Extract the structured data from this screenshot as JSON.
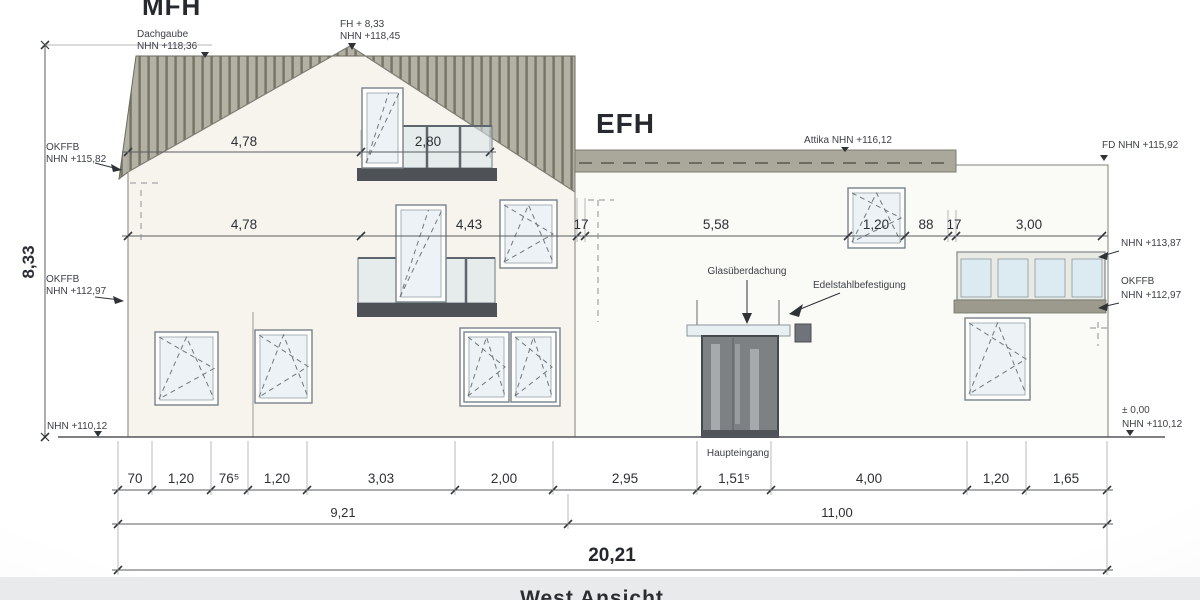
{
  "titles": {
    "mfh": "MFH",
    "efh": "EFH",
    "view": "West Ansicht"
  },
  "levels": {
    "dachgaube_1": "Dachgaube",
    "dachgaube_2": "NHN +118,36",
    "fh_1": "FH + 8,33",
    "fh_2": "NHN +118,45",
    "attika": "Attika NHN +116,12",
    "fd": "FD NHN +115,92",
    "okffb_left_up_1": "OKFFB",
    "okffb_left_up_2": "NHN +115,82",
    "okffb_left_low_1": "OKFFB",
    "okffb_left_low_2": "NHN +112,97",
    "ground_left": "NHN +110,12",
    "right_113": "NHN +113,87",
    "okffb_right_1": "OKFFB",
    "okffb_right_2": "NHN +112,97",
    "zero_right_1": "± 0,00",
    "zero_right_2": "NHN +110,12"
  },
  "entrance": {
    "canopy": "Glasüberdachung",
    "fixing": "Edelstahlbefestigung",
    "entry": "Haupteingang"
  },
  "dims": {
    "height": "8,33",
    "roof": [
      "4,78",
      "2,80"
    ],
    "mid": [
      "4,78",
      "4,43",
      "17",
      "5,58",
      "1,20",
      "88",
      "17",
      "3,00"
    ],
    "bottom": [
      "70",
      "1,20",
      "76⁵",
      "1,20",
      "3,03",
      "2,00",
      "2,95",
      "1,51⁵",
      "4,00",
      "1,20",
      "1,65"
    ],
    "subtotals": [
      "9,21",
      "11,00"
    ],
    "total": "20,21"
  }
}
